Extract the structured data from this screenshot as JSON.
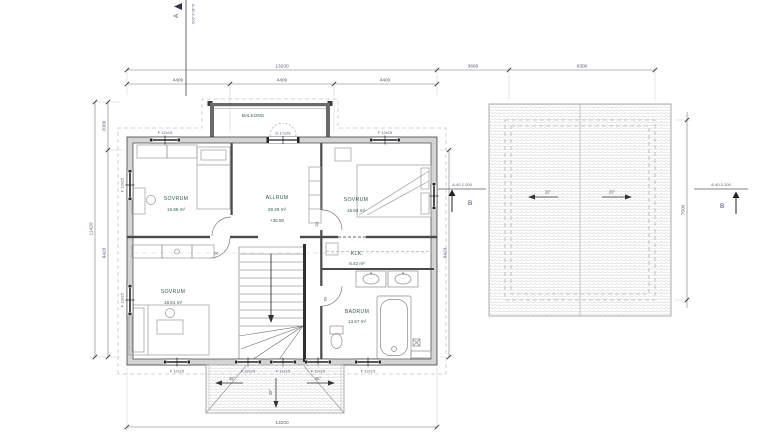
{
  "section_markers": {
    "top": {
      "label": "A",
      "ref": "A-40.2-200"
    },
    "roof_left": {
      "label": "B",
      "ref": "A-40.2-200"
    },
    "roof_right": {
      "label": "B",
      "ref": "A-40.2-200"
    }
  },
  "dimensions": {
    "top_total": "13200",
    "seg1": "4400",
    "seg2": "4400",
    "seg3": "4400",
    "gap_to_roof": "3660",
    "roof_width": "6300",
    "bottom_total": "13200",
    "left_total": "11420",
    "left_upper": "2000",
    "left_lower": "9420",
    "right_side": "9420",
    "roof_depth": "7500"
  },
  "rooms": {
    "bedroom_nw": {
      "name": "SOVRUM",
      "area": "15.88 m²"
    },
    "livingroom": {
      "name": "ALLRUM",
      "area": "29.29 m²",
      "level": "+30.50"
    },
    "bedroom_ne": {
      "name": "SOVRUM",
      "area": "15.84 m²"
    },
    "closet": {
      "name": "KLK.",
      "area": "6.42 m²"
    },
    "bathroom": {
      "name": "BADRUM",
      "area": "13.57 m²"
    },
    "bedroom_sw": {
      "name": "SOVRUM",
      "area": "18.81 m²"
    },
    "balcony": {
      "name": "BALKONG"
    }
  },
  "openings": {
    "window_top_left": "F 12x15",
    "window_top_right": "F 12x15",
    "window_left_upper": "F 13x15",
    "window_left_lower": "F 13x15",
    "window_bottom_1": "F 12x15",
    "window_bottom_2": "F 12x15",
    "window_bottom_3": "F 12x15",
    "window_bottom_4": "F 12x15",
    "window_bottom_5": "F 12x15",
    "balcony_door": "D 17x25",
    "interior_door": "D8"
  },
  "roof_plan": {
    "slope_left": "20°",
    "slope_right": "20°"
  },
  "porch_roof": {
    "slope_left": "45°",
    "slope_right": "45°",
    "slope_center": "20°"
  }
}
